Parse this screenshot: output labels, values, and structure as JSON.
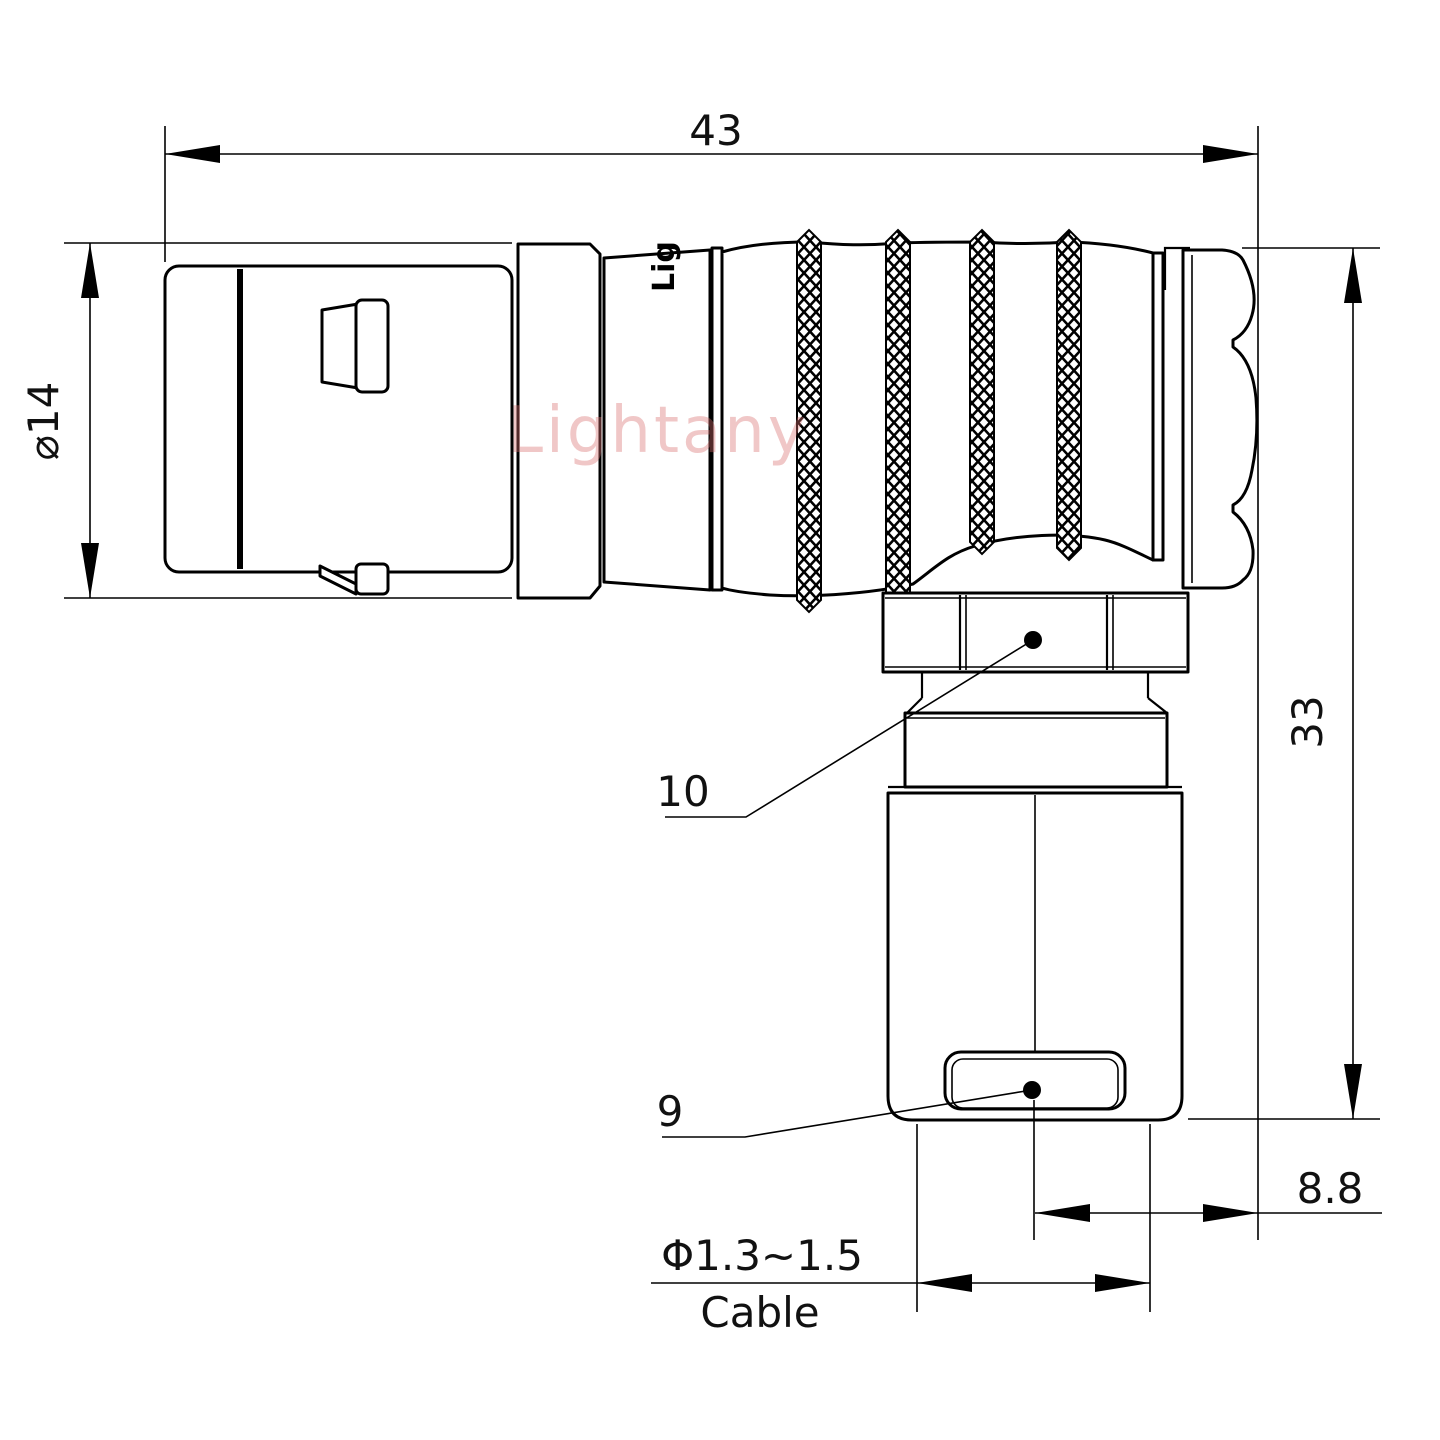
{
  "drawing": {
    "title": "right-angle connector elbow plug",
    "dimensions": {
      "overall_length": "43",
      "front_diameter": "⌀14",
      "overall_height": "33",
      "rear_face_to_cable_axis": "8.8"
    },
    "cable_note": {
      "diameter_range": "Φ1.3~1.5",
      "label": "Cable"
    },
    "callouts": {
      "coupling_nut": "10",
      "cable_bushing": "9"
    },
    "watermark": "Lightany",
    "body_engraving": "Lig",
    "colors": {
      "line": "#000000",
      "watermark": "#d96f6f",
      "background": "#ffffff"
    }
  }
}
